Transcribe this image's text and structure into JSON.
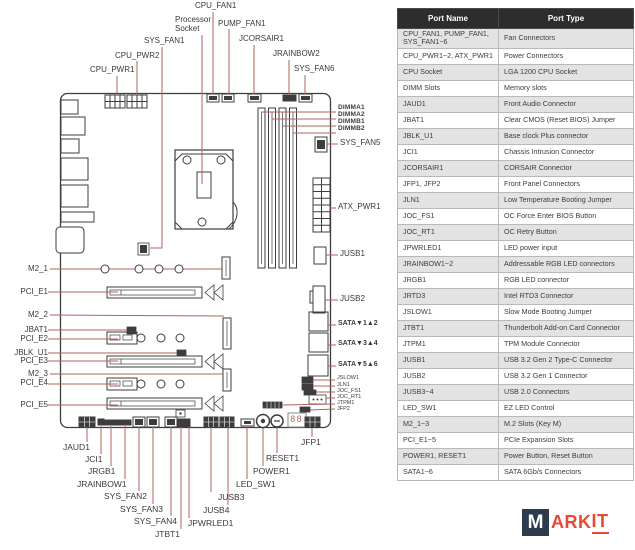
{
  "colors": {
    "leader_line": "#b2625c",
    "component_outline": "#3d3d3d",
    "table_header_bg": "#2d2d2d",
    "table_alt_row_bg": "#e3e3e3",
    "logo_red": "#e84a34",
    "logo_navy": "#2e3b4e"
  },
  "diagram": {
    "top": {
      "cpu_fan1": "CPU_FAN1",
      "processor": "Processor",
      "socket": "Socket",
      "pump_fan1": "PUMP_FAN1",
      "jcorsair1": "JCORSAIR1",
      "jrainbow2": "JRAINBOW2",
      "sys_fan6": "SYS_FAN6",
      "sys_fan1": "SYS_FAN1",
      "cpu_pwr2": "CPU_PWR2",
      "cpu_pwr1": "CPU_PWR1"
    },
    "right": {
      "dimma1": "DIMMA1",
      "dimma2": "DIMMA2",
      "dimmb1": "DIMMB1",
      "dimmb2": "DIMMB2",
      "sys_fan5": "SYS_FAN5",
      "atx_pwr1": "ATX_PWR1",
      "jusb1": "JUSB1",
      "jusb2": "JUSB2",
      "sata12": "SATA▼1▲2",
      "sata34": "SATA▼3▲4",
      "sata56": "SATA▼5▲6",
      "jslow1": "JSLOW1",
      "jln1": "JLN1",
      "joc_fs1": "JOC_FS1",
      "joc_rt1": "JOC_RT1",
      "jtpm1": "JTPM1",
      "jfp2": "JFP2"
    },
    "left": {
      "m2_1": "M2_1",
      "pci_e1": "PCI_E1",
      "m2_2": "M2_2",
      "jbat1": "JBAT1",
      "pci_e2": "PCI_E2",
      "jblk_u1": "JBLK_U1",
      "pci_e3": "PCI_E3",
      "m2_3": "M2_3",
      "pci_e4": "PCI_E4",
      "pci_e5": "PCI_E5"
    },
    "bottom": {
      "jaud1": "JAUD1",
      "jci1": "JCI1",
      "jrgb1": "JRGB1",
      "jrainbow1": "JRAINBOW1",
      "sys_fan2": "SYS_FAN2",
      "sys_fan3": "SYS_FAN3",
      "sys_fan4": "SYS_FAN4",
      "jtbt1": "JTBT1",
      "jpwrled1": "JPWRLED1",
      "jusb4": "JUSB4",
      "jusb3": "JUSB3",
      "led_sw1": "LED_SW1",
      "power1": "POWER1",
      "reset1": "RESET1",
      "jfp1": "JFP1"
    },
    "debug_display": "88"
  },
  "table": {
    "headers": [
      "Port Name",
      "Port Type"
    ],
    "rows": [
      {
        "name": "CPU_FAN1, PUMP_FAN1, SYS_FAN1~6",
        "type": "Fan Connectors"
      },
      {
        "name": "CPU_PWR1~2, ATX_PWR1",
        "type": "Power Connectors"
      },
      {
        "name": "CPU Socket",
        "type": "LGA 1200 CPU Socket"
      },
      {
        "name": "DIMM Slots",
        "type": "Memory slots"
      },
      {
        "name": "JAUD1",
        "type": "Front Audio Connector"
      },
      {
        "name": "JBAT1",
        "type": "Clear CMOS (Reset BIOS) Jumper"
      },
      {
        "name": "JBLK_U1",
        "type": "Base clock Plus connector"
      },
      {
        "name": "JCI1",
        "type": "Chassis Intrusion Connector"
      },
      {
        "name": "JCORSAIR1",
        "type": "CORSAIR Connector"
      },
      {
        "name": "JFP1, JFP2",
        "type": "Front Panel Connectors"
      },
      {
        "name": "JLN1",
        "type": "Low Temperature Booting Jumper"
      },
      {
        "name": "JOC_FS1",
        "type": "OC Force Enter BIOS Button"
      },
      {
        "name": "JOC_RT1",
        "type": "OC Retry Button"
      },
      {
        "name": "JPWRLED1",
        "type": "LED power input"
      },
      {
        "name": "JRAINBOW1~2",
        "type": "Addressable RGB LED connectors"
      },
      {
        "name": "JRGB1",
        "type": "RGB LED connector"
      },
      {
        "name": "JRTD3",
        "type": "Intel RTD3 Connector"
      },
      {
        "name": "JSLOW1",
        "type": "Slow Mode Booting Jumper"
      },
      {
        "name": "JTBT1",
        "type": "Thunderbolt Add-on Card Connector"
      },
      {
        "name": "JTPM1",
        "type": "TPM Module Connector"
      },
      {
        "name": "JUSB1",
        "type": "USB 3.2 Gen 2 Type-C Connector"
      },
      {
        "name": "JUSB2",
        "type": "USB 3.2 Gen 1 Connector"
      },
      {
        "name": "JUSB3~4",
        "type": "USB 2.0 Connectors"
      },
      {
        "name": "LED_SW1",
        "type": "EZ LED Control"
      },
      {
        "name": "M2_1~3",
        "type": "M.2 Slots (Key M)"
      },
      {
        "name": "PCI_E1~5",
        "type": "PCIe Expansion Slots"
      },
      {
        "name": "POWER1, RESET1",
        "type": "Power Button, Reset Button"
      },
      {
        "name": "SATA1~6",
        "type": "SATA 6Gb/s Connectors"
      }
    ]
  },
  "logo": {
    "m": "M",
    "ark": "ARK",
    "it": "IT"
  }
}
